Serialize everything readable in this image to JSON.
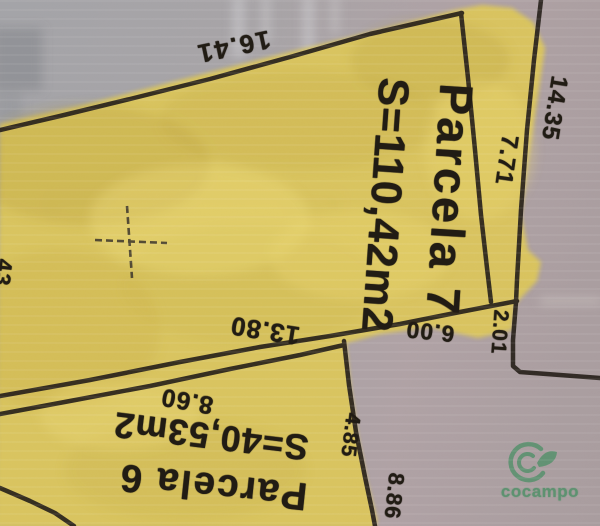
{
  "parcel7": {
    "name": "Parcela 7",
    "area": "S=110,42m2"
  },
  "parcel6": {
    "name": "Parcela 6",
    "area": "S=40,53m2"
  },
  "measurements": {
    "top_edge": "16.41",
    "right_outer": "14.35",
    "right_inner": "7.71",
    "right_step": "2.01",
    "bottom_edge": "13.80",
    "bottom_right": "6.00",
    "parcel6_top": "8.60",
    "parcel6_right": "4.85",
    "parcel6_lower_right": "8.86",
    "left_edge_partial": "43"
  },
  "logo": {
    "brand": "cocampo"
  },
  "colors": {
    "highlight_yellow": "#ddc75c",
    "boundary_line": "#26201a",
    "logo_green": "#55906b",
    "paper_gray": "#a9a5a8"
  }
}
